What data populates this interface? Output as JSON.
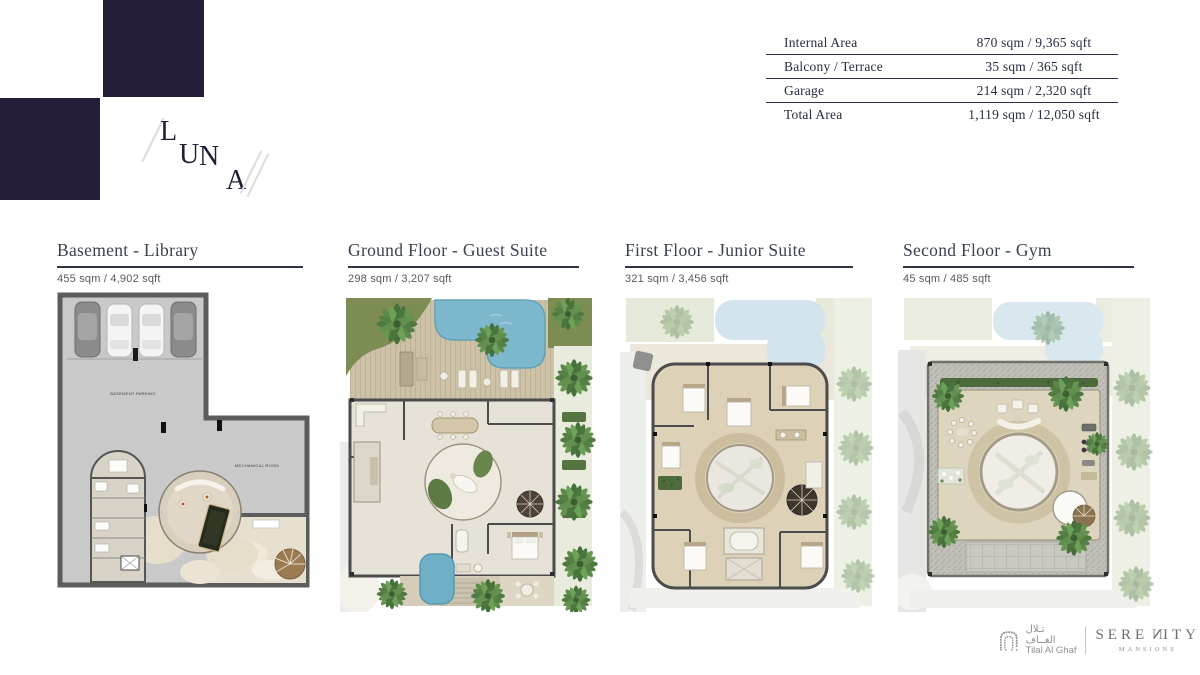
{
  "logo": {
    "letters": [
      "L",
      "U",
      "N",
      "A"
    ],
    "square_color": "#261d3a"
  },
  "area_table": {
    "rows": [
      {
        "label": "Internal Area",
        "value": "870 sqm / 9,365 sqft"
      },
      {
        "label": "Balcony / Terrace",
        "value": "35 sqm / 365 sqft"
      },
      {
        "label": "Garage",
        "value": "214 sqm / 2,320 sqft"
      },
      {
        "label": "Total Area",
        "value": "1,119 sqm / 12,050 sqft"
      }
    ]
  },
  "floors": [
    {
      "title": "Basement - Library",
      "area": "455 sqm / 4,902 sqft",
      "labels": {
        "parking": "BASEMENT PARKING",
        "mechanical": "MECHANICAL ROOM"
      }
    },
    {
      "title": "Ground Floor - Guest Suite",
      "area": "298 sqm / 3,207 sqft"
    },
    {
      "title": "First Floor - Junior Suite",
      "area": "321 sqm / 3,456 sqft"
    },
    {
      "title": "Second Floor - Gym",
      "area": "45 sqm / 485 sqft"
    }
  ],
  "footer": {
    "developer": {
      "arabic": "تـلال الغــاف",
      "english": "Tilal Al Ghaf"
    },
    "brand": {
      "pre": "SERE",
      "n": "N",
      "post": "ITY",
      "tagline": "MANSIONS"
    }
  },
  "palette": {
    "wall": "#4c4c4c",
    "pool_blue": "#7db8cc",
    "grass_green": "#7c8c52",
    "deck_wood": "#cdc2a8",
    "interior_stone": "#e6e1d6",
    "parking_gray": "#c9c9c9"
  }
}
